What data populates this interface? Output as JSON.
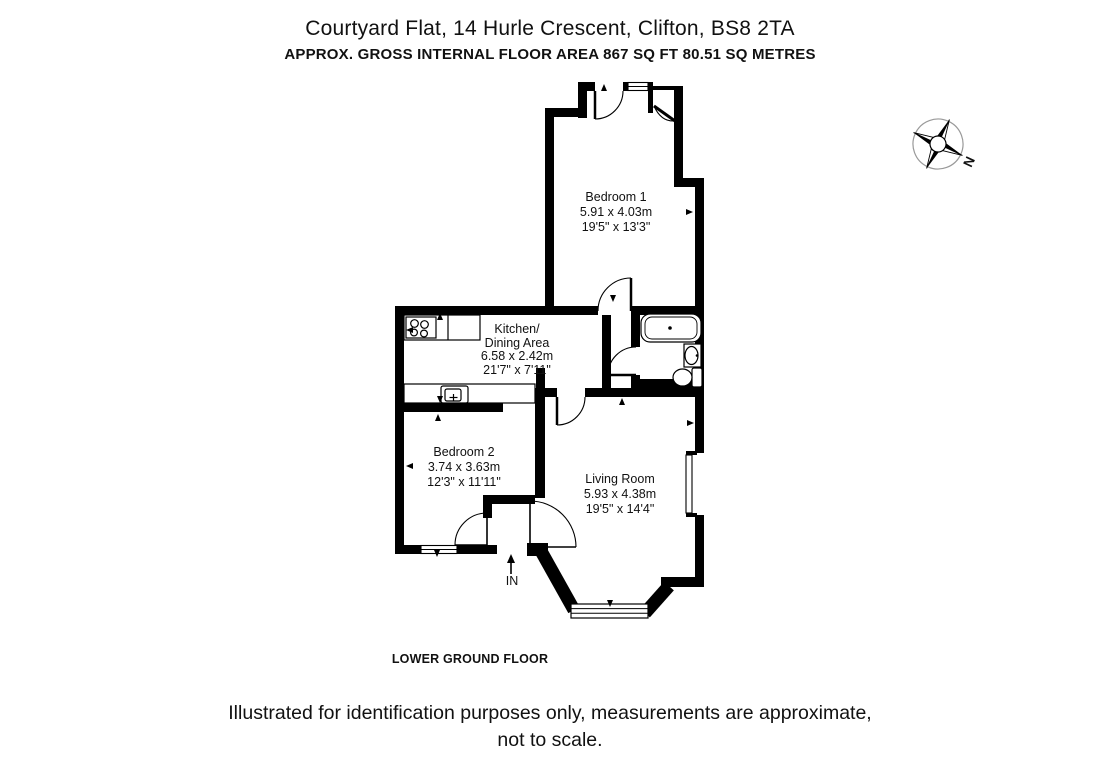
{
  "header": {
    "title": "Courtyard Flat, 14 Hurle Crescent, Clifton, BS8 2TA",
    "subtitle": "APPROX. GROSS INTERNAL FLOOR AREA 867 SQ FT 80.51 SQ METRES"
  },
  "floorplan": {
    "floor_label": "LOWER GROUND FLOOR",
    "entrance_label": "IN",
    "compass_label": "N",
    "rooms": [
      {
        "name": "Bedroom 1",
        "metric": "5.91 x 4.03m",
        "imperial": "19'5\" x 13'3\""
      },
      {
        "name": "Kitchen/",
        "name_line2": "Dining Area",
        "metric": "6.58 x 2.42m",
        "imperial": "21'7\" x 7'11\""
      },
      {
        "name": "Bedroom 2",
        "metric": "3.74 x 3.63m",
        "imperial": "12'3\" x 11'11\""
      },
      {
        "name": "Living Room",
        "metric": "5.93 x 4.38m",
        "imperial": "19'5\" x 14'4\""
      }
    ]
  },
  "footer": {
    "line1": "Illustrated for identification purposes only, measurements are approximate,",
    "line2": "not to scale."
  },
  "colors": {
    "wall": "#000000",
    "background": "#ffffff"
  }
}
